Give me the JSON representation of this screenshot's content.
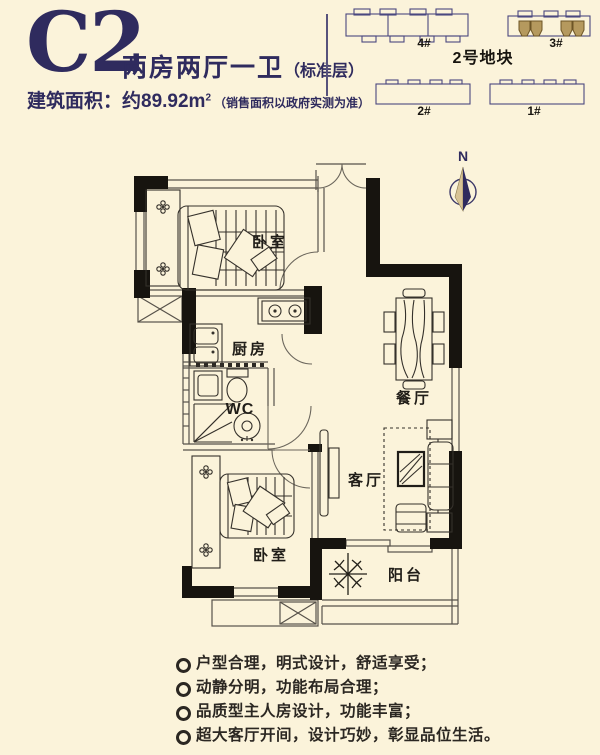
{
  "header": {
    "unit_code": "C2",
    "unit_type": "两房两厅一卫",
    "unit_type_note": "（标准层）",
    "area_label": "建筑面积：",
    "area_value": "约89.92m",
    "area_sup": "2",
    "area_note": "（销售面积以政府实测为准）"
  },
  "site_plan": {
    "plot_label": "2号地块",
    "buildings": [
      {
        "id": "4",
        "label": "4#",
        "highlighted": false
      },
      {
        "id": "3",
        "label": "3#",
        "highlighted": true
      },
      {
        "id": "2",
        "label": "2#",
        "highlighted": false
      },
      {
        "id": "1",
        "label": "1#",
        "highlighted": false
      }
    ]
  },
  "floor_plan": {
    "compass_label": "N",
    "rooms": [
      {
        "id": "bedroom-1",
        "label": "卧室"
      },
      {
        "id": "kitchen",
        "label": "厨房"
      },
      {
        "id": "wc",
        "label": "WC"
      },
      {
        "id": "dining",
        "label": "餐厅"
      },
      {
        "id": "living",
        "label": "客厅"
      },
      {
        "id": "bedroom-2",
        "label": "卧室"
      },
      {
        "id": "balcony",
        "label": "阳台"
      }
    ]
  },
  "features": {
    "items": [
      "户型合理，明式设计，舒适享受；",
      "动静分明，功能布局合理；",
      "品质型主人房设计，功能丰富；",
      "超大客厅开间，设计巧妙，彰显品位生活。"
    ]
  },
  "colors": {
    "background": "#fbf3da",
    "accent_navy": "#2f2b5e",
    "wall_black": "#17140f",
    "highlight_tan": "#b5995e",
    "text_dark": "#2b2722"
  }
}
